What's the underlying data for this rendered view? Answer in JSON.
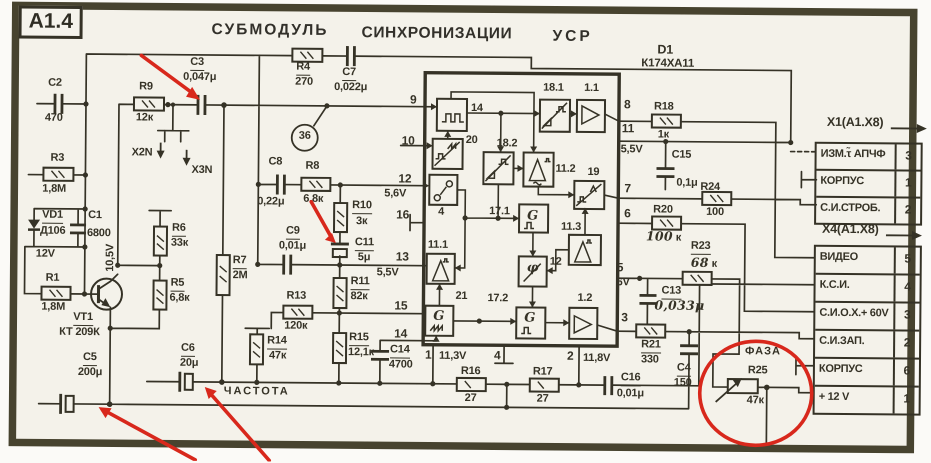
{
  "module_tag": "A1.4",
  "title": {
    "word1": "СУБМОДУЛЬ",
    "word2": "СИНХРОНИЗАЦИИ",
    "word3": "УСР"
  },
  "ic": {
    "ref": "D1",
    "part": "К174ХА11",
    "blocks": {
      "b14": "14",
      "b20": "20",
      "b18_1": "18.1",
      "b1_1": "1.1",
      "b18_2": "18.2",
      "b11_2": "11.2",
      "b4": "4",
      "b19": "19",
      "b17_1": "17.1",
      "b11_1": "11.1",
      "b11_3": "11.3",
      "b12": "12",
      "b21": "21",
      "b17_2": "17.2",
      "b1_2": "1.2"
    },
    "glyphs": {
      "generator": "G",
      "phase": "φ"
    },
    "pins_left": {
      "p9": "9",
      "p10": "10",
      "p12": "12",
      "p16": "16",
      "p13": "13",
      "p15": "15",
      "p14": "14"
    },
    "pins_bottom": {
      "p1": "1",
      "p4": "4",
      "p2": "2"
    },
    "pins_right": {
      "p8": "8",
      "p11": "11",
      "p7": "7",
      "p6": "6",
      "p5": "5",
      "p3": "3"
    }
  },
  "components": {
    "c2": {
      "ref": "C2",
      "value": "470"
    },
    "r3": {
      "ref": "R3",
      "value": "1,8М"
    },
    "vd1": {
      "ref": "VD1",
      "value": "Д106"
    },
    "c1": {
      "ref": "C1",
      "value": "6800"
    },
    "r1": {
      "ref": "R1",
      "value": "1,8М"
    },
    "vt1": {
      "ref": "VT1",
      "value": "КТ 209К"
    },
    "r9": {
      "ref": "R9",
      "value": "12к"
    },
    "c3": {
      "ref": "C3",
      "value": "0,047μ"
    },
    "r4": {
      "ref": "R4",
      "value": "270"
    },
    "c7": {
      "ref": "C7",
      "value": "0,022μ"
    },
    "r6": {
      "ref": "R6",
      "value": "33к"
    },
    "r5": {
      "ref": "R5",
      "value": "6,8к"
    },
    "r7": {
      "ref": "R7",
      "value": "2М"
    },
    "c8": {
      "ref": "C8",
      "value": "0,22μ"
    },
    "r8": {
      "ref": "R8",
      "value": "6,8к"
    },
    "r10": {
      "ref": "R10",
      "value": "3к"
    },
    "c9": {
      "ref": "C9",
      "value": "0,01μ"
    },
    "c11": {
      "ref": "C11",
      "value": "5μ"
    },
    "r11": {
      "ref": "R11",
      "value": "82к"
    },
    "r13": {
      "ref": "R13",
      "value": "120к"
    },
    "r14": {
      "ref": "R14",
      "value": "47к"
    },
    "r15": {
      "ref": "R15",
      "value": "12,1к"
    },
    "c14": {
      "ref": "C14",
      "value": "4700"
    },
    "c6": {
      "ref": "C6",
      "value": "20μ"
    },
    "c5": {
      "ref": "C5",
      "value": "200μ"
    },
    "r16": {
      "ref": "R16",
      "value": "27"
    },
    "r17": {
      "ref": "R17",
      "value": "27"
    },
    "c16": {
      "ref": "C16",
      "value": "0,01μ"
    },
    "c4": {
      "ref": "C4",
      "value": "150"
    },
    "r21": {
      "ref": "R21",
      "value": "330"
    },
    "c13": {
      "ref": "C13",
      "value": "0,033μ"
    },
    "r23": {
      "ref": "R23",
      "value_hand": "68",
      "value_unit": " к"
    },
    "r20": {
      "ref": "R20",
      "value_hand": "100",
      "value_unit": " к"
    },
    "r24": {
      "ref": "R24",
      "value": "100"
    },
    "r18": {
      "ref": "R18",
      "value": "1к"
    },
    "c15": {
      "ref": "C15",
      "value": "0,1μ"
    },
    "r25": {
      "ref": "R25",
      "value": "47к"
    }
  },
  "voltages": {
    "v1": "12V",
    "v2": "10,5V",
    "v3": "5,6V",
    "v4": "5,5V",
    "v5": "5,5V",
    "v6": "6V",
    "v7": "11,3V",
    "v8": "11,8V"
  },
  "nets": {
    "node36": "36",
    "x2n": "X2N",
    "x3n": "X3N",
    "chastota": "ЧАСТОТА",
    "faza": "ФАЗА"
  },
  "connectors": {
    "x1": {
      "header": "X1(A1.X8)",
      "rows": [
        {
          "label": "ИЗМ.τ̃ АПЧФ",
          "pin": "3"
        },
        {
          "label": "КОРПУС",
          "pin": "1"
        },
        {
          "label": "С.И.СТРОБ.",
          "pin": "2"
        }
      ]
    },
    "x4": {
      "header": "X4(A1.X8)",
      "rows": [
        {
          "label": "ВИДЕО",
          "pin": "5"
        },
        {
          "label": "К.С.И.",
          "pin": "4"
        },
        {
          "label": "С.И.О.Х.+ 60V",
          "pin": "3"
        },
        {
          "label": "С.И.ЗАП.",
          "pin": "2"
        },
        {
          "label": "КОРПУС",
          "pin": "6"
        },
        {
          "label": "+ 12 V",
          "pin": "1"
        }
      ]
    }
  },
  "colors": {
    "ink": "#353226",
    "frame": "#47432f",
    "annotation_red": "#d8281c",
    "paper": "#f4f2ea"
  }
}
